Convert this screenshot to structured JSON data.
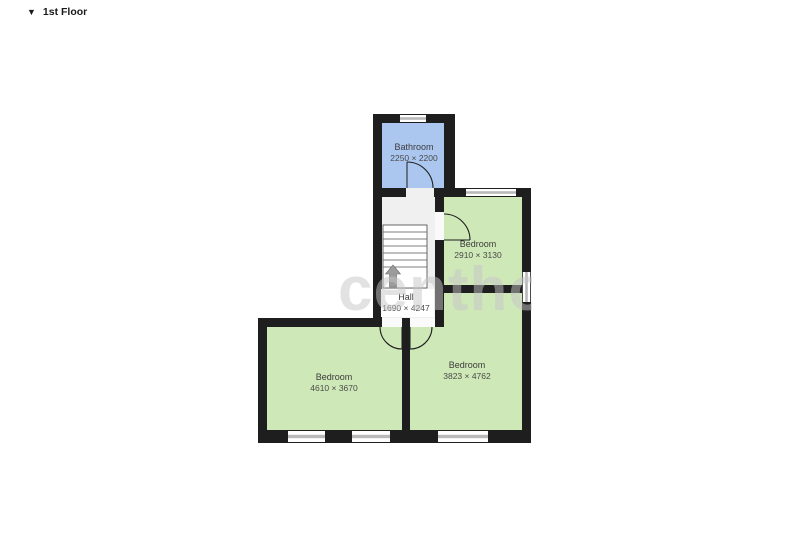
{
  "header": {
    "floor_label": "1st Floor",
    "collapse_icon": "▼"
  },
  "watermark": "centho",
  "plan": {
    "rooms": [
      {
        "id": "bathroom",
        "name": "Bathroom",
        "dimensions": "2250 × 2200",
        "fill": "#abc7f0"
      },
      {
        "id": "bedroom-top-right",
        "name": "Bedroom",
        "dimensions": "2910 × 3130",
        "fill": "#cfe8b8"
      },
      {
        "id": "hall",
        "name": "Hall",
        "dimensions": "1690 × 4247",
        "fill": "#f0f0f0"
      },
      {
        "id": "bedroom-bottom-left",
        "name": "Bedroom",
        "dimensions": "4610 × 3670",
        "fill": "#cfe8b8"
      },
      {
        "id": "bedroom-bottom-right",
        "name": "Bedroom",
        "dimensions": "3823 × 4762",
        "fill": "#cfe8b8"
      }
    ],
    "stairs": {
      "direction": "up"
    },
    "counts": {
      "windows": 6,
      "doors": 4
    },
    "colors": {
      "wall": "#1e1e1e",
      "window": "#b9b9b9",
      "bathroom": "#abc7f0",
      "bedroom": "#cfe8b8",
      "hall": "#f0f0f0",
      "stair_arrow": "#9c9c9c",
      "label_text": "#3c3c3c"
    }
  }
}
